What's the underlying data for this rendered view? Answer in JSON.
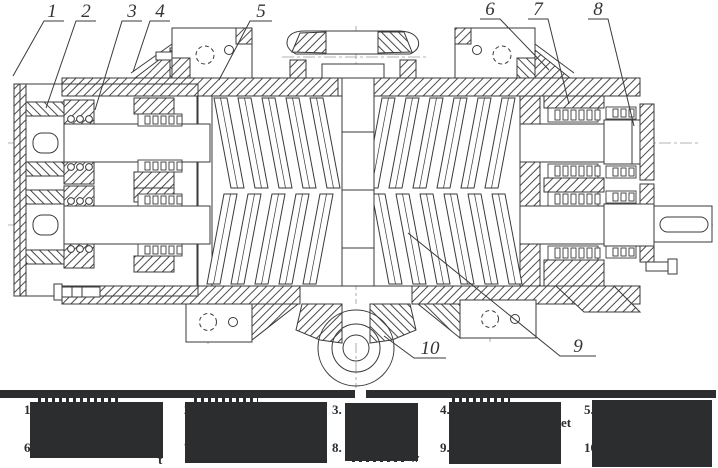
{
  "figure": {
    "title": "Sectional assembly drawing of a twin-screw rotary machine",
    "callouts": [
      {
        "label": "1"
      },
      {
        "label": "2"
      },
      {
        "label": "3"
      },
      {
        "label": "4"
      },
      {
        "label": "5"
      },
      {
        "label": "6"
      },
      {
        "label": "7"
      },
      {
        "label": "8"
      },
      {
        "label": "9"
      },
      {
        "label": "10"
      }
    ]
  },
  "legend": {
    "redacted": true,
    "items": [
      {
        "number": "1."
      },
      {
        "number": "2."
      },
      {
        "number": "3."
      },
      {
        "number": "4."
      },
      {
        "number": "5."
      },
      {
        "number": "6."
      },
      {
        "number": "7."
      },
      {
        "number": "8."
      },
      {
        "number": "9."
      },
      {
        "number": "10."
      }
    ],
    "visible_fragments": [
      {
        "text": "t"
      },
      {
        "text": "w"
      },
      {
        "text": "et"
      }
    ]
  },
  "colors": {
    "line": "#3a3a3a",
    "hatch": "#4a4a4a",
    "centerline": "#9a9a9a",
    "redaction": "#2b2d2e",
    "background": "#ffffff"
  }
}
